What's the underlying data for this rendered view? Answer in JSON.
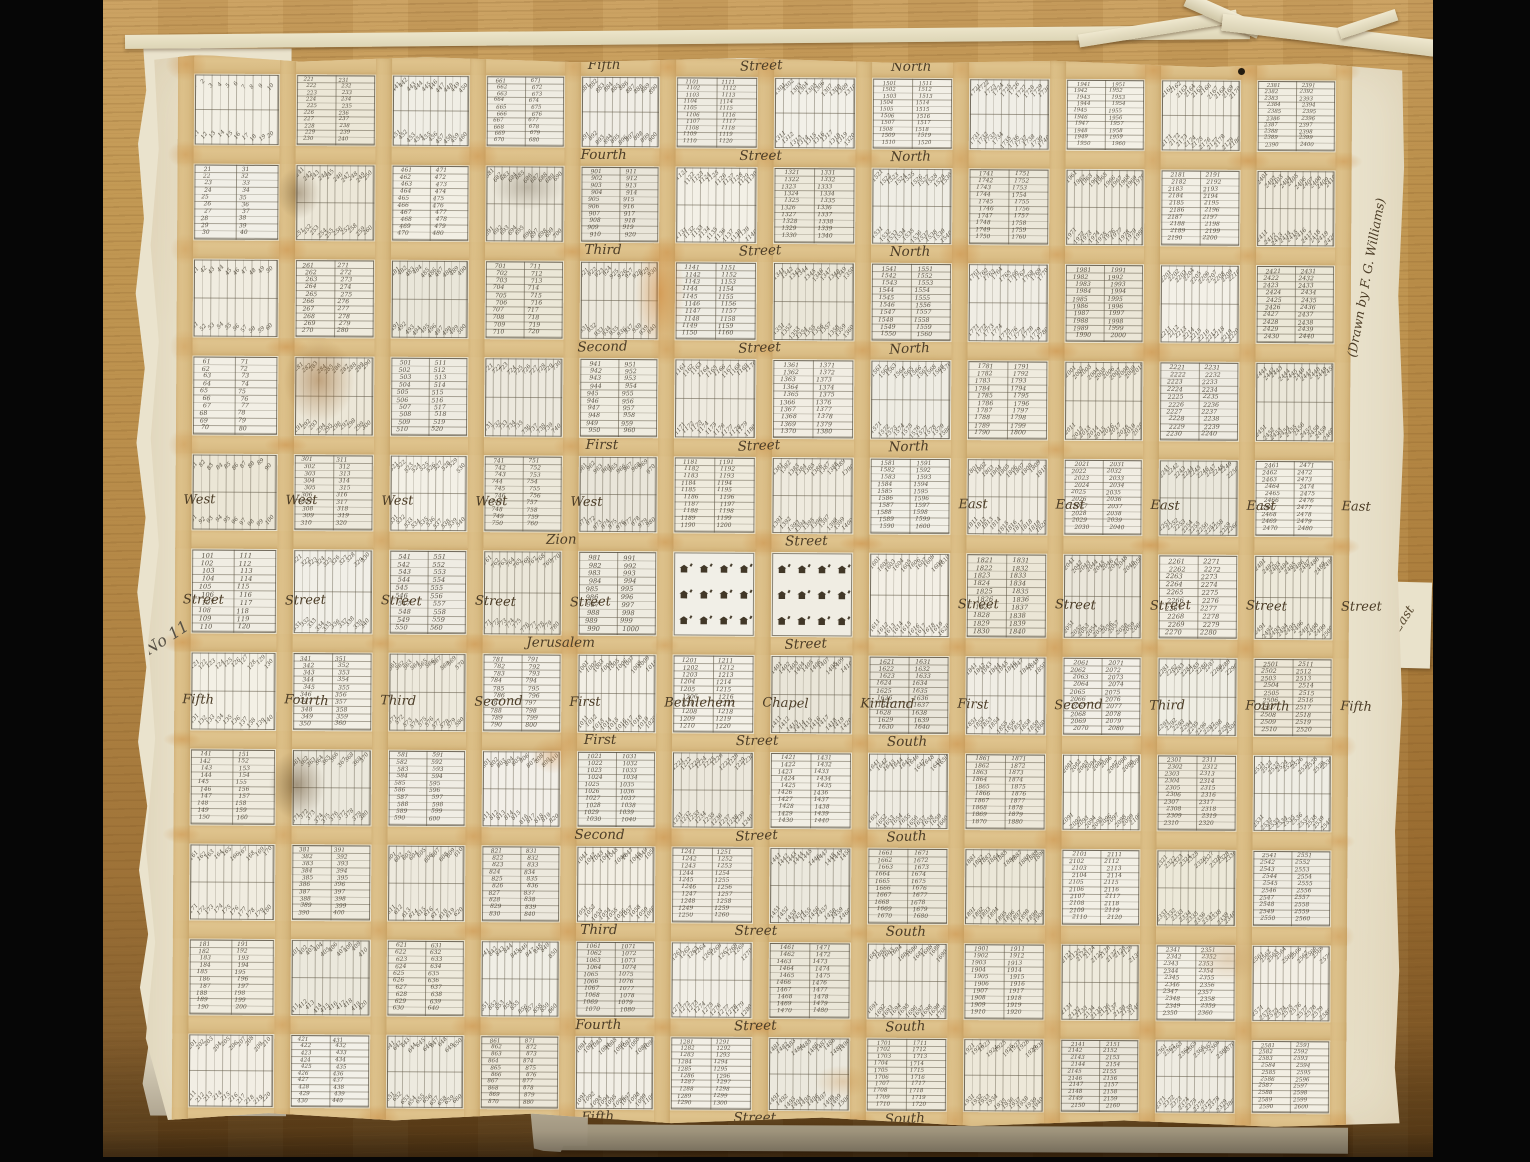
{
  "annotations": {
    "sheet_number": "No 11",
    "credit": "(Drawn by F. G. Williams)",
    "margin_east_word": "East"
  },
  "streets": {
    "horizontal": [
      {
        "words": [
          "Fifth",
          "Street",
          "North"
        ]
      },
      {
        "words": [
          "Fourth",
          "Street",
          "North"
        ]
      },
      {
        "words": [
          "Third",
          "Street",
          "North"
        ]
      },
      {
        "words": [
          "Second",
          "Street",
          "North"
        ]
      },
      {
        "words": [
          "First",
          "Street",
          "North"
        ]
      },
      {
        "words": [
          "Zion",
          "Street"
        ]
      },
      {
        "words": [
          "Jerusalem",
          "Street"
        ]
      },
      {
        "words": [
          "First",
          "Street",
          "South"
        ]
      },
      {
        "words": [
          "Second",
          "Street",
          "South"
        ]
      },
      {
        "words": [
          "Third",
          "Street",
          "South"
        ]
      },
      {
        "words": [
          "Fourth",
          "Street",
          "South"
        ]
      },
      {
        "words": [
          "Fifth",
          "Street",
          "South"
        ]
      }
    ],
    "vertical": [
      {
        "prefix": "West",
        "name": "Fifth",
        "street_word": "Street"
      },
      {
        "prefix": "West",
        "name": "Fourth",
        "street_word": "Street"
      },
      {
        "prefix": "West",
        "name": "Third",
        "street_word": "Street"
      },
      {
        "prefix": "West",
        "name": "Second",
        "street_word": "Street"
      },
      {
        "prefix": "West",
        "name": "First",
        "street_word": "Street"
      },
      {
        "prefix": "",
        "name": "Bethlehem",
        "street_word": ""
      },
      {
        "prefix": "",
        "name": "Chapel",
        "street_word": ""
      },
      {
        "prefix": "",
        "name": "Kirtland",
        "street_word": ""
      },
      {
        "prefix": "East",
        "name": "First",
        "street_word": "Street"
      },
      {
        "prefix": "East",
        "name": "Second",
        "street_word": "Street"
      },
      {
        "prefix": "East",
        "name": "Third",
        "street_word": "Street"
      },
      {
        "prefix": "East",
        "name": "Fourth",
        "street_word": "Street"
      },
      {
        "prefix": "East",
        "name": "Fifth",
        "street_word": "Street"
      }
    ]
  },
  "plat": {
    "rows": 11,
    "cols": 12,
    "lots_per_block": 20,
    "column_lot_bases": [
      1,
      221,
      441,
      661,
      881,
      1101,
      1301,
      1501,
      1721,
      1941,
      2161,
      2381
    ],
    "temple_blocks": {
      "row_index": 5,
      "col_indexes": [
        5,
        6
      ],
      "temples_per_block": 12,
      "total_temples": 24
    }
  }
}
